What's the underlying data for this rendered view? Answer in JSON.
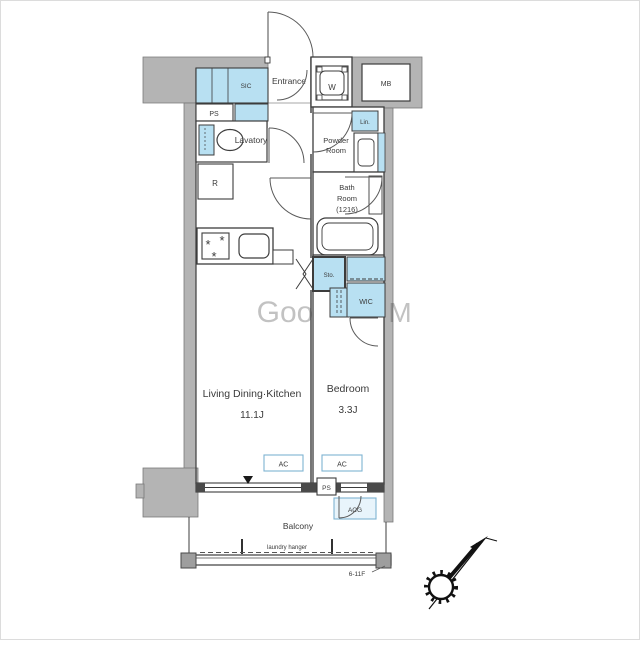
{
  "plan": {
    "labels": {
      "entrance": "Entrance",
      "sic": "SIC",
      "ps_top": "PS",
      "lavatory": "Lavatory",
      "washer": "W",
      "meter_box": "MB",
      "linen": "Lin.",
      "powder_1": "Powder",
      "powder_2": "Room",
      "bath_1": "Bath",
      "bath_2": "Room",
      "bath_3": "(1216)",
      "fridge": "R",
      "storage": "Sto.",
      "wic": "WIC",
      "ldk_name": "Living Dining·Kitchen",
      "ldk_size": "11.1J",
      "bedroom_name": "Bedroom",
      "bedroom_size": "3.3J",
      "balcony": "Balcony",
      "ac_living": "AC",
      "ac_bedroom": "AC",
      "ps_bottom": "PS",
      "ac_outdoor": "ACG",
      "laundry_hanger": "laundry hanger",
      "floor_range": "6-11F",
      "watermark_1": "Goo",
      "watermark_2": "M"
    },
    "colors": {
      "closet_fill": "#b8e0f2",
      "wall_fill": "#b4b4b4",
      "line": "#3c3c3c",
      "ac_accent": "#7fb3d2",
      "ac_outdoor_fill": "#e8f4fb"
    }
  }
}
